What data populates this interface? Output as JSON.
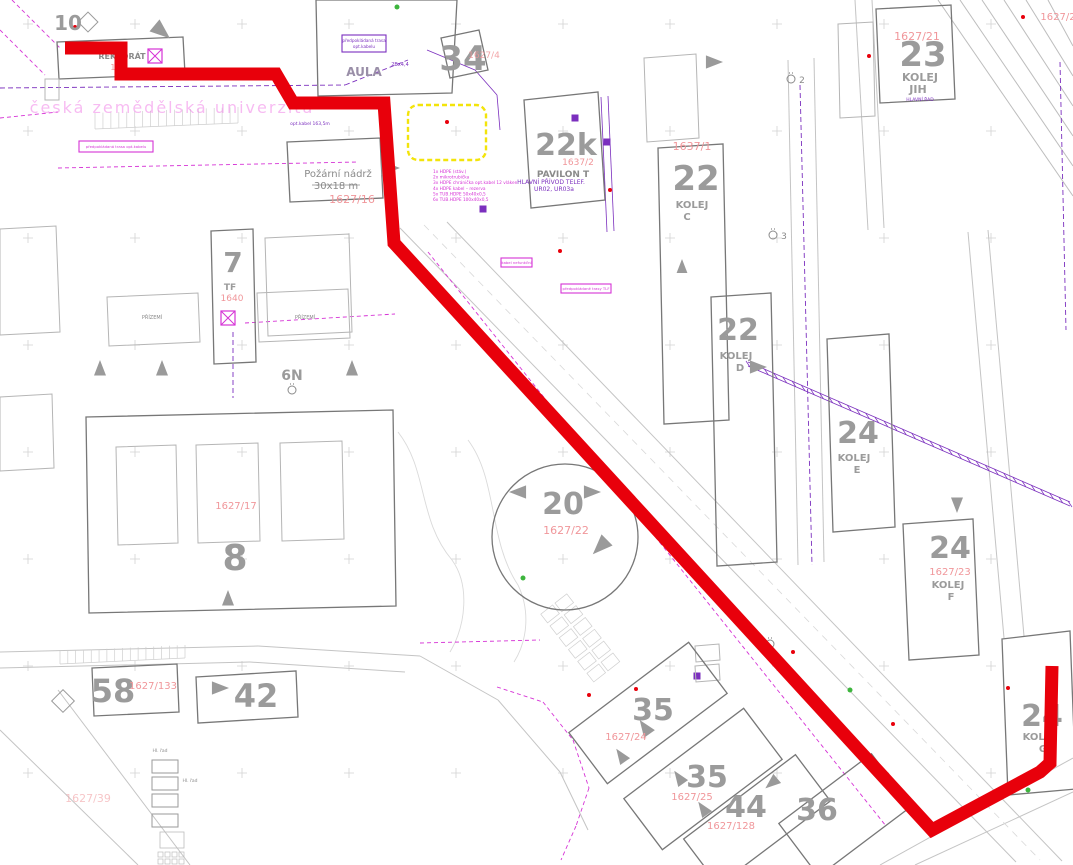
{
  "map": {
    "colors": {
      "bld": "#9b9b9b",
      "bld2": "#8a8a8a",
      "bldp": "#9a8fa8",
      "parcel": "#f0969a",
      "wm": "#f07ae6",
      "purple": "#7b2fbe",
      "magenta": "#d633d6",
      "route": "#e8000b",
      "yellow": "#f3e40a",
      "green": "#3db53d"
    },
    "route": {
      "color": "#e8000b",
      "width": 13,
      "points": [
        [
          65,
          48
        ],
        [
          121,
          48
        ],
        [
          121,
          74
        ],
        [
          276,
          74
        ],
        [
          293,
          103
        ],
        [
          384,
          103
        ],
        [
          394,
          243
        ],
        [
          932,
          830
        ],
        [
          1040,
          772
        ],
        [
          1050,
          763
        ],
        [
          1052,
          666
        ]
      ]
    },
    "yellow_highlight": {
      "x": 408,
      "y": 105,
      "w": 78,
      "h": 55
    },
    "labels": [
      {
        "t": "10",
        "x": 68,
        "y": 30,
        "s": 20,
        "k": "bld",
        "b": true
      },
      {
        "t": "REKTORÁT",
        "x": 122,
        "y": 59,
        "s": 8,
        "k": "bld2",
        "b": true
      },
      {
        "t": "164",
        "x": 118,
        "y": 70,
        "s": 8,
        "k": "parcel"
      },
      {
        "t": "česká zemědělská univerzita",
        "x": 172,
        "y": 113,
        "s": 16,
        "k": "wm",
        "o": 0.5,
        "ls": 2
      },
      {
        "t": "1639",
        "x": 357,
        "y": 48,
        "s": 9,
        "k": "parcel"
      },
      {
        "t": "AULA",
        "x": 364,
        "y": 76,
        "s": 12,
        "k": "bldp",
        "b": true
      },
      {
        "t": "2Bx4,4",
        "x": 400,
        "y": 66,
        "s": 5,
        "k": "purple"
      },
      {
        "t": "34",
        "x": 463,
        "y": 70,
        "s": 34,
        "k": "bld",
        "b": true
      },
      {
        "t": "1627/4",
        "x": 484,
        "y": 58,
        "s": 9,
        "k": "parcel",
        "o": 0.85
      },
      {
        "t": "22k",
        "x": 566,
        "y": 155,
        "s": 30,
        "k": "bld",
        "b": true
      },
      {
        "t": "1637/2",
        "x": 578,
        "y": 165,
        "s": 9,
        "k": "parcel"
      },
      {
        "t": "PAVILON T",
        "x": 563,
        "y": 177,
        "s": 9,
        "k": "bld2",
        "b": true
      },
      {
        "t": "Požární nádrž",
        "x": 338,
        "y": 177,
        "s": 10,
        "k": "bld2"
      },
      {
        "t": "30x18 m",
        "x": 336,
        "y": 189,
        "s": 10,
        "k": "bld2"
      },
      {
        "t": "1627/16",
        "x": 352,
        "y": 203,
        "s": 11,
        "k": "parcel"
      },
      {
        "t": "opt.kabel 163,5m",
        "x": 310,
        "y": 125,
        "s": 4.5,
        "k": "purple"
      },
      {
        "t": "1627/21",
        "x": 917,
        "y": 40,
        "s": 11,
        "k": "parcel"
      },
      {
        "t": "23",
        "x": 923,
        "y": 66,
        "s": 34,
        "k": "bld",
        "b": true
      },
      {
        "t": "KOLEJ",
        "x": 920,
        "y": 81,
        "s": 11,
        "k": "bld",
        "b": true
      },
      {
        "t": "JIH",
        "x": 918,
        "y": 93,
        "s": 11,
        "k": "bld",
        "b": true
      },
      {
        "t": "HLAVNÍ ŘAD",
        "x": 920,
        "y": 101,
        "s": 4.5,
        "k": "purple"
      },
      {
        "t": "1627/2",
        "x": 1058,
        "y": 20,
        "s": 10,
        "k": "parcel"
      },
      {
        "t": "1637/1",
        "x": 692,
        "y": 150,
        "s": 11,
        "k": "parcel"
      },
      {
        "t": "22",
        "x": 696,
        "y": 190,
        "s": 34,
        "k": "bld",
        "b": true
      },
      {
        "t": "KOLEJ",
        "x": 692,
        "y": 208,
        "s": 10,
        "k": "bld",
        "b": true
      },
      {
        "t": "C",
        "x": 687,
        "y": 220,
        "s": 10,
        "k": "bld",
        "b": true
      },
      {
        "t": "2",
        "x": 802,
        "y": 83,
        "s": 9,
        "k": "bld2"
      },
      {
        "t": "3",
        "x": 784,
        "y": 239,
        "s": 9,
        "k": "bld2"
      },
      {
        "t": "22",
        "x": 738,
        "y": 340,
        "s": 30,
        "k": "bld",
        "b": true
      },
      {
        "t": "KOLEJ",
        "x": 736,
        "y": 359,
        "s": 10,
        "k": "bld",
        "b": true
      },
      {
        "t": "D",
        "x": 740,
        "y": 371,
        "s": 10,
        "k": "bld",
        "b": true
      },
      {
        "t": "HLAVNÍ PŘÍVOD TELEF.",
        "x": 551,
        "y": 184,
        "s": 6,
        "k": "purple"
      },
      {
        "t": "UR02, UR03a",
        "x": 554,
        "y": 191,
        "s": 6,
        "k": "purple"
      },
      {
        "t": "24",
        "x": 858,
        "y": 443,
        "s": 30,
        "k": "bld",
        "b": true
      },
      {
        "t": "KOLEJ",
        "x": 854,
        "y": 461,
        "s": 10,
        "k": "bld",
        "b": true
      },
      {
        "t": "E",
        "x": 857,
        "y": 473,
        "s": 10,
        "k": "bld",
        "b": true
      },
      {
        "t": "24",
        "x": 950,
        "y": 558,
        "s": 30,
        "k": "bld",
        "b": true
      },
      {
        "t": "1627/23",
        "x": 950,
        "y": 575,
        "s": 10,
        "k": "parcel"
      },
      {
        "t": "KOLEJ",
        "x": 948,
        "y": 588,
        "s": 10,
        "k": "bld",
        "b": true
      },
      {
        "t": "F",
        "x": 951,
        "y": 600,
        "s": 10,
        "k": "bld",
        "b": true
      },
      {
        "t": "20",
        "x": 563,
        "y": 514,
        "s": 30,
        "k": "bld",
        "b": true
      },
      {
        "t": "1627/22",
        "x": 566,
        "y": 534,
        "s": 11,
        "k": "parcel"
      },
      {
        "t": "8",
        "x": 235,
        "y": 570,
        "s": 36,
        "k": "bld",
        "b": true
      },
      {
        "t": "1627/17",
        "x": 236,
        "y": 509,
        "s": 10,
        "k": "parcel"
      },
      {
        "t": "7",
        "x": 233,
        "y": 272,
        "s": 28,
        "k": "bld",
        "b": true
      },
      {
        "t": "TF",
        "x": 230,
        "y": 290,
        "s": 9,
        "k": "bld",
        "b": true
      },
      {
        "t": "1640",
        "x": 232,
        "y": 301,
        "s": 9,
        "k": "parcel"
      },
      {
        "t": "PŘÍZEMÍ",
        "x": 152,
        "y": 319,
        "s": 5,
        "k": "bld2"
      },
      {
        "t": "PŘÍZEMÍ",
        "x": 305,
        "y": 319,
        "s": 5,
        "k": "bld2"
      },
      {
        "t": "6N",
        "x": 292,
        "y": 380,
        "s": 14,
        "k": "bld",
        "b": true
      },
      {
        "t": "58",
        "x": 113,
        "y": 702,
        "s": 32,
        "k": "bld",
        "b": true
      },
      {
        "t": "1627/133",
        "x": 153,
        "y": 689,
        "s": 10,
        "k": "parcel"
      },
      {
        "t": "42",
        "x": 256,
        "y": 707,
        "s": 32,
        "k": "bld",
        "b": true
      },
      {
        "t": "35",
        "x": 653,
        "y": 720,
        "s": 30,
        "k": "bld",
        "b": true
      },
      {
        "t": "1627/24",
        "x": 626,
        "y": 740,
        "s": 10,
        "k": "parcel"
      },
      {
        "t": "35",
        "x": 707,
        "y": 787,
        "s": 30,
        "k": "bld",
        "b": true
      },
      {
        "t": "1627/25",
        "x": 692,
        "y": 800,
        "s": 10,
        "k": "parcel"
      },
      {
        "t": "44",
        "x": 746,
        "y": 817,
        "s": 30,
        "k": "bld",
        "b": true
      },
      {
        "t": "1627/128",
        "x": 731,
        "y": 829,
        "s": 10,
        "k": "parcel"
      },
      {
        "t": "36",
        "x": 817,
        "y": 820,
        "s": 30,
        "k": "bld",
        "b": true
      },
      {
        "t": "24",
        "x": 1042,
        "y": 726,
        "s": 30,
        "k": "bld",
        "b": true
      },
      {
        "t": "KOLEJ",
        "x": 1039,
        "y": 740,
        "s": 10,
        "k": "bld",
        "b": true
      },
      {
        "t": "G",
        "x": 1043,
        "y": 752,
        "s": 10,
        "k": "bld",
        "b": true
      },
      {
        "t": "1627/39",
        "x": 88,
        "y": 802,
        "s": 11,
        "k": "parcel",
        "o": 0.55
      },
      {
        "t": "Hl. řad",
        "x": 160,
        "y": 752,
        "s": 4.5,
        "k": "bld2"
      },
      {
        "t": "Hl. řad",
        "x": 190,
        "y": 782,
        "s": 4.5,
        "k": "bld2"
      }
    ],
    "boxed_labels": [
      {
        "t": "předpokládaná trasa",
        "t2": "opt.kabelu",
        "x": 342,
        "y": 35,
        "w": 44,
        "h": 17,
        "k": "purple"
      },
      {
        "t": "předpokládaná trasa opt.kabelu",
        "x": 79,
        "y": 141,
        "w": 74,
        "h": 11,
        "k": "magenta"
      },
      {
        "t": "kabel nefunkční",
        "x": 501,
        "y": 258,
        "w": 31,
        "h": 9,
        "k": "magenta"
      },
      {
        "t": "předpokládané trasy TLF",
        "x": 561,
        "y": 284,
        "w": 50,
        "h": 9,
        "k": "magenta"
      }
    ],
    "cable_list": {
      "x": 433,
      "y": 173,
      "line_height": 5.6,
      "size": 4.3,
      "items": [
        "1x HDPE (stáv.)",
        "2x mikrotrubička",
        "3x HDPE chránička opt.kabel 12 vláken",
        "4x HDPE kabel – rezerva",
        "5x TUB.HDPE 50x40x0,5",
        "6x TUB.HDPE 100x40x0,5"
      ]
    }
  }
}
